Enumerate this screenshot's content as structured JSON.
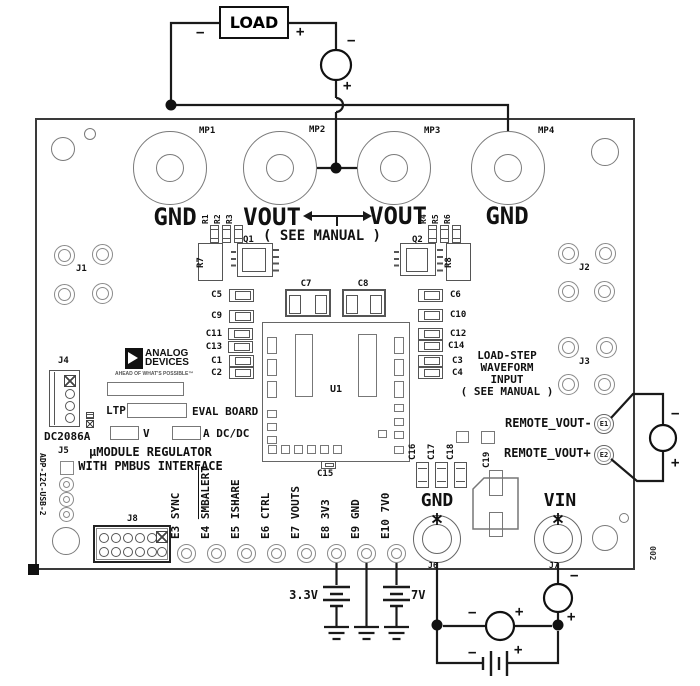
{
  "signs": {
    "minus": "−",
    "plus": "+"
  },
  "external": {
    "load_label": "LOAD",
    "ammeter_top": "A",
    "voltmeter_right": "V",
    "voltmeter_bottom": "V",
    "ammeter_bottom": "A",
    "battery_33_label": "3.3V",
    "battery_7_label": "7V"
  },
  "board": {
    "mp": [
      "MP1",
      "MP2",
      "MP3",
      "MP4"
    ],
    "turret_names": [
      "GND",
      "VOUT",
      "VOUT",
      "GND"
    ],
    "see_manual": "( SEE MANUAL )",
    "q1": "Q1",
    "q2": "Q2",
    "r7": "R7",
    "r8": "R8",
    "u1": "U1",
    "r_left": [
      "R1",
      "R2",
      "R3"
    ],
    "r_right": [
      "R4",
      "R5",
      "R6"
    ],
    "caps_left": [
      "C5",
      "C9",
      "C11",
      "C13",
      "C1",
      "C2"
    ],
    "caps_right": [
      "C6",
      "C10",
      "C12",
      "C14",
      "C3",
      "C4"
    ],
    "c7": "C7",
    "c8": "C8",
    "c15": "C15",
    "caps_small": [
      "C16",
      "C17",
      "C18"
    ],
    "c19": "C19",
    "j1": "J1",
    "j2": "J2",
    "j3": "J3",
    "j4": "J4",
    "j5": "J5",
    "j6": "J6",
    "j7": "J7",
    "j8": "J8",
    "logo": {
      "top": "ANALOG",
      "bottom": "DEVICES",
      "tagline": "AHEAD OF WHAT'S POSSIBLE™"
    },
    "silk": {
      "model": "DC2086A",
      "ltp": "LTP",
      "eval": "EVAL BOARD",
      "v": "V",
      "adcdc": "A DC/DC",
      "line1": "μMODULE REGULATOR",
      "line2": "WITH PMBUS INTERFACE",
      "left_side": "ADP-I2C-USB-2",
      "right_side": "002"
    },
    "loadstep": [
      "LOAD-STEP",
      "WAVEFORM",
      "INPUT",
      "( SEE MANUAL )"
    ],
    "remote_minus": "REMOTE_VOUT-",
    "remote_plus": "REMOTE_VOUT+",
    "e1": "E1",
    "e2": "E2",
    "pins": [
      {
        "d": "E3",
        "n": "SYNC"
      },
      {
        "d": "E4",
        "n": "SMBALERT"
      },
      {
        "d": "E5",
        "n": "ISHARE"
      },
      {
        "d": "E6",
        "n": "CTRL"
      },
      {
        "d": "E7",
        "n": "VOUTS"
      },
      {
        "d": "E8",
        "n": "3V3"
      },
      {
        "d": "E9",
        "n": "GND"
      },
      {
        "d": "E10",
        "n": "7V0"
      }
    ],
    "gnd": "GND",
    "vin": "VIN"
  },
  "icons": {
    "star_mark": "asterisk-star",
    "battery": "battery-cell",
    "ground": "earth-ground",
    "junction": "junction-dot"
  },
  "colors": {
    "wire": "#1a1a1a",
    "silk": "#111111",
    "component": "#555555",
    "pad": "#888888"
  }
}
